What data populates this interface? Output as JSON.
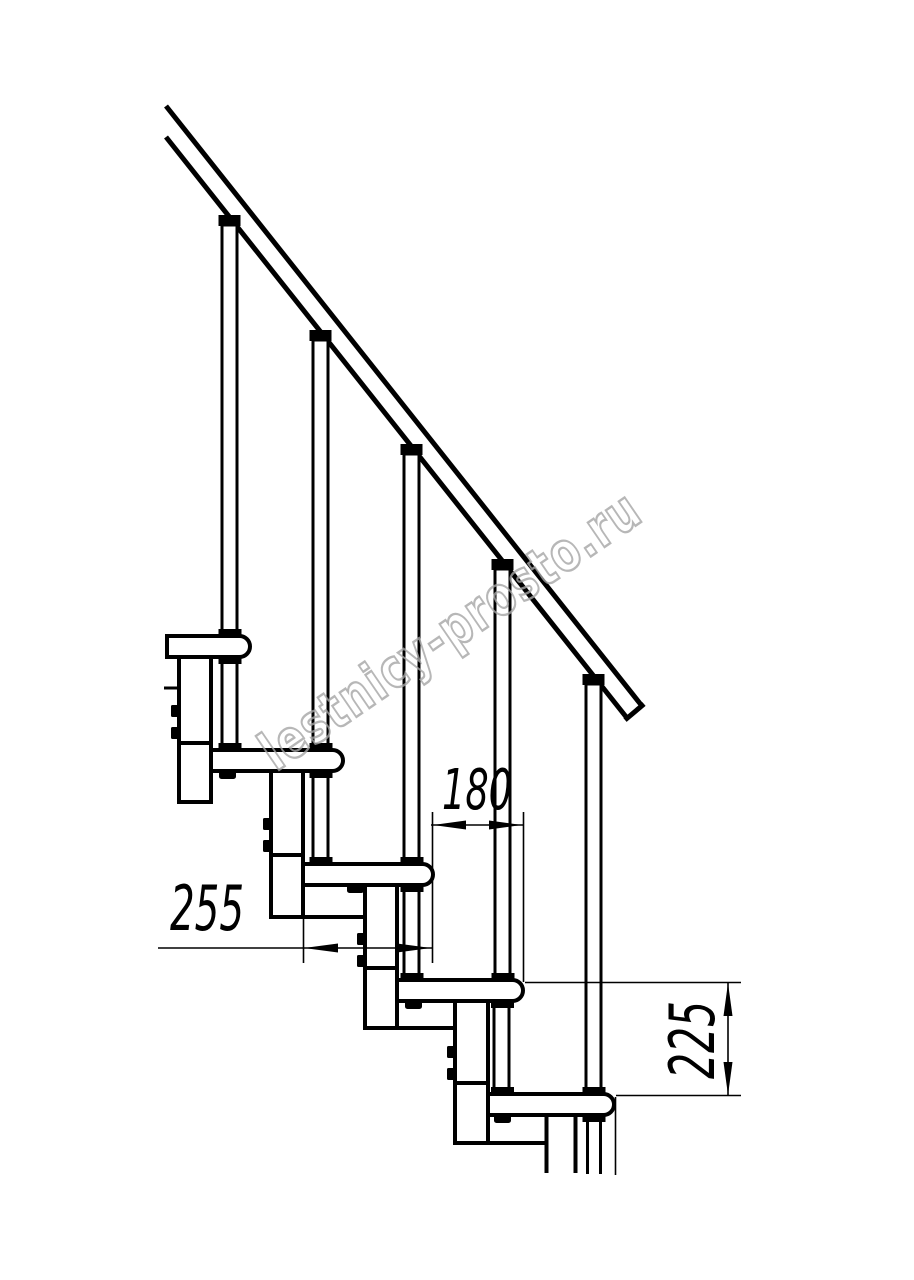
{
  "drawing": {
    "title": "staircase-side-elevation",
    "watermark_text": "lestnicy-prosto.ru",
    "dimensions": {
      "step_run": "180",
      "tread_depth": "255",
      "step_height": "225"
    },
    "colors": {
      "line": "#000000",
      "watermark": "#a6a6a6",
      "background": "#ffffff"
    }
  }
}
